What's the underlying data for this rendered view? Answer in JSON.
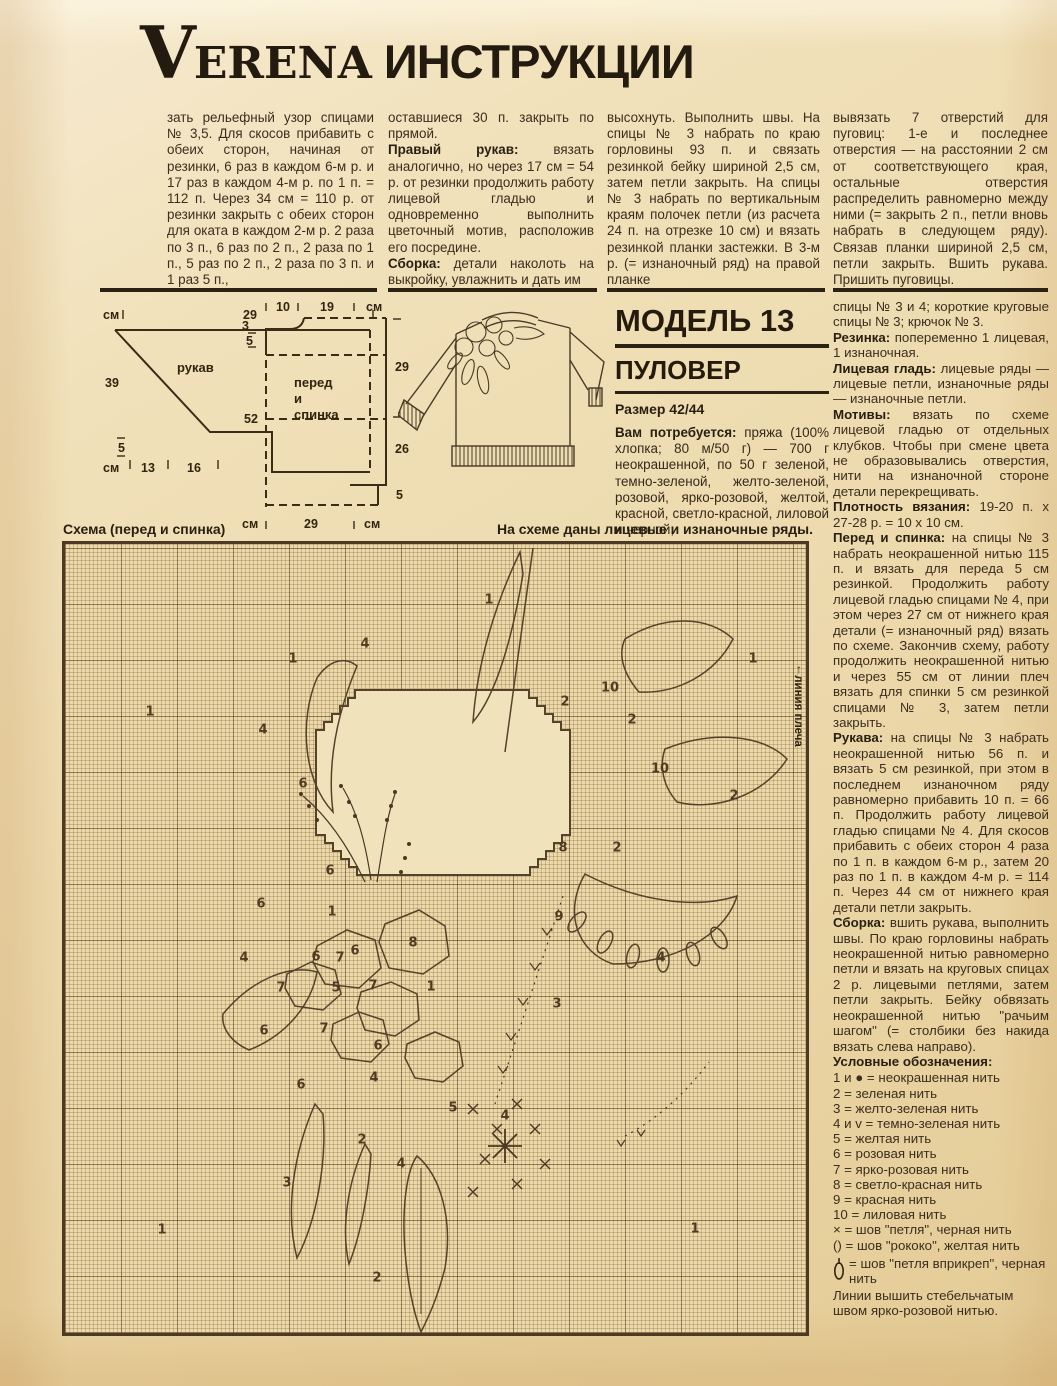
{
  "masthead": {
    "v": "V",
    "erena": "ERENA",
    "cyrillic": " ИНСТРУКЦИИ"
  },
  "colors": {
    "paper": "#f0e0b6",
    "ink": "#36291a",
    "grid": "#7a5c3a",
    "rule": "#2c2214"
  },
  "top_columns": [
    [
      [
        {
          "t": "зать рельефный узор спицами № 3,5. Для скосов прибавить с обеих сторон, начиная от резинки, 6 раз в каждом 6-м р. и 17 раз в каждом 4-м р. по 1 п. = 112 п. Через 34 см = 110 р. от резинки закрыть с обеих сторон для оката в каждом 2-м р. 2 раза по 3 п., 6 раз по 2 п., 2 раза по 1 п., 5 раз по 2 п., 2 раза по 3 п. и 1 раз 5 п.,"
        }
      ]
    ],
    [
      [
        {
          "t": "оставшиеся 30 п. закрыть по прямой."
        }
      ],
      [
        {
          "b": "Правый рукав:"
        },
        {
          "t": " вязать аналогично, но через 17 см = 54 р. от резинки продолжить работу лицевой гладью и одновременно выполнить цветочный мотив, расположив его посредине."
        }
      ],
      [
        {
          "b": "Сборка:"
        },
        {
          "t": " детали наколоть на выкройку, увлажнить и дать им"
        }
      ]
    ],
    [
      [
        {
          "t": "высохнуть. Выполнить швы. На спицы № 3 набрать по краю горловины 93 п. и связать резинкой бейку шириной 2,5 см, затем петли закрыть. На спицы № 3 набрать по вертикальным краям полочек петли (из расчета 24 п. на отрезке 10 см) и вязать резинкой планки застежки. В 3-м р. (= изнаночный ряд) на правой планке"
        }
      ]
    ],
    [
      [
        {
          "t": "вывязать 7 отверстий для пуговиц: 1-е и последнее отверстия — на расстоянии 2 см от соответствующего края, остальные отверстия распределить равномерно между ними (= закрыть 2 п., петли вновь набрать в следующем ряду). Связав планки шириной 2,5 см, петли закрыть. Вшить рукава. Пришить пуговицы."
        }
      ]
    ]
  ],
  "model": {
    "title": "МОДЕЛЬ 13",
    "subtitle": "ПУЛОВЕР",
    "size": "Размер 42/44",
    "paras": [
      [
        {
          "b": "Вам потребуется:"
        },
        {
          "t": " пряжа (100% хлопка; 80 м/50 г) — 700 г неокрашенной, по 50 г зеленой, темно-зеленой, желто-зеленой, розовой, ярко-розовой, желтой, красной, светло-красной, лиловой и черной;"
        }
      ]
    ]
  },
  "right_column": [
    [
      {
        "t": "спицы № 3 и 4; короткие круговые спицы № 3; крючок № 3."
      }
    ],
    [
      {
        "b": "Резинка:"
      },
      {
        "t": " попеременно 1 лицевая, 1 изнаночная."
      }
    ],
    [
      {
        "b": "Лицевая гладь:"
      },
      {
        "t": " лицевые ряды — лицевые петли, изнаночные ряды — изнаночные петли."
      }
    ],
    [
      {
        "b": "Мотивы:"
      },
      {
        "t": " вязать по схеме лицевой гладью от отдельных клубков. Чтобы при смене цвета не образовывались отверстия, нити на изнаночной стороне детали перекрещивать."
      }
    ],
    [
      {
        "b": "Плотность вязания:"
      },
      {
        "t": " 19-20 п. x 27-28 р. = 10 x 10 см."
      }
    ],
    [
      {
        "b": "Перед и спинка:"
      },
      {
        "t": " на спицы № 3 набрать неокрашенной нитью 115 п. и вязать для переда 5 см резинкой. Продолжить работу лицевой гладью спицами № 4, при этом через 27 см от нижнего края детали (= изнаночный ряд) вязать по схеме. Закончив схему, работу продолжить неокрашенной нитью и через 55 см от линии плеч вязать для спинки 5 см резинкой спицами № 3, затем петли закрыть."
      }
    ],
    [
      {
        "b": "Рукава:"
      },
      {
        "t": " на спицы № 3 набрать неокрашенной нитью 56 п. и вязать 5 см резинкой, при этом в последнем изнаночном ряду равномерно прибавить 10 п. = 66 п. Продолжить работу лицевой гладью спицами № 4. Для скосов прибавить с обеих сторон 4 раза по 1 п. в каждом 6-м р., затем 20 раз по 1 п. в каждом 4-м р. = 114 п. Через 44 см от нижнего края детали петли закрыть."
      }
    ],
    [
      {
        "b": "Сборка:"
      },
      {
        "t": " вшить рукава, выполнить швы. По краю горловины набрать неокрашенной нитью равномерно петли и вязать на круговых спицах 2 р. лицевыми петлями, затем петли закрыть. Бейку обвязать неокрашенной нитью \"рачьим шагом\" (= столбики без накида вязать слева направо)."
      }
    ],
    [
      {
        "b": "Условные обозначения:"
      }
    ]
  ],
  "legend": [
    "1 и ● = неокрашенная нить",
    "2 = зеленая нить",
    "3 = желто-зеленая нить",
    "4 и v = темно-зеленая нить",
    "5 = желтая нить",
    "6 = розовая нить",
    "7 = ярко-розовая нить",
    "8 = светло-красная нить",
    "9 = красная нить",
    "10 = лиловая нить",
    "× = шов \"петля\", черная нить",
    "() = шов \"рококо\", желтая нить"
  ],
  "legend_loop": {
    "rest": "= шов \"петля вприкреп\", черная нить"
  },
  "legend_note": "Линии вышить стебельчатым швом ярко-розовой нитью.",
  "schema": {
    "left_header": "Схема (перед и спинка)",
    "right_header": "На схеме даны лицевые и изнаночные ряды.",
    "shoulder_label": "линия плеча",
    "shoulder_arrow": "↑"
  },
  "diagrams": {
    "sleeve": {
      "label": "рукав",
      "unit_tl": "см",
      "unit_bl": "см",
      "w_top": "29",
      "h_left": "39",
      "h_rib": "5",
      "w_b1": "13",
      "w_b2": "16"
    },
    "front": {
      "label1": "перед",
      "label2": "и",
      "label3": "спинка",
      "unit_t": "см",
      "unit_bl": "см",
      "unit_br": "см",
      "t1": "10",
      "t2": "19",
      "l1": "3",
      "l2": "5",
      "l3": "52",
      "r1": "29",
      "r2": "26",
      "r3": "5",
      "b1": "29"
    }
  },
  "chart": {
    "labels": [
      {
        "t": "1",
        "x": 424,
        "y": 56
      },
      {
        "t": "4",
        "x": 300,
        "y": 100
      },
      {
        "t": "1",
        "x": 228,
        "y": 115
      },
      {
        "t": "1",
        "x": 688,
        "y": 115
      },
      {
        "t": "1",
        "x": 85,
        "y": 168
      },
      {
        "t": "4",
        "x": 198,
        "y": 186
      },
      {
        "t": "10",
        "x": 545,
        "y": 144
      },
      {
        "t": "2",
        "x": 500,
        "y": 158
      },
      {
        "t": "2",
        "x": 567,
        "y": 176
      },
      {
        "t": "10",
        "x": 595,
        "y": 225
      },
      {
        "t": "2",
        "x": 669,
        "y": 252
      },
      {
        "t": "6",
        "x": 238,
        "y": 240
      },
      {
        "t": "8",
        "x": 498,
        "y": 304
      },
      {
        "t": "2",
        "x": 552,
        "y": 304
      },
      {
        "t": "6",
        "x": 265,
        "y": 327
      },
      {
        "t": "6",
        "x": 196,
        "y": 360
      },
      {
        "t": "1",
        "x": 267,
        "y": 368
      },
      {
        "t": "9",
        "x": 494,
        "y": 373
      },
      {
        "t": "8",
        "x": 348,
        "y": 399
      },
      {
        "t": "4",
        "x": 179,
        "y": 414
      },
      {
        "t": "6",
        "x": 251,
        "y": 413
      },
      {
        "t": "7",
        "x": 275,
        "y": 414
      },
      {
        "t": "6",
        "x": 290,
        "y": 407
      },
      {
        "t": "7",
        "x": 216,
        "y": 444
      },
      {
        "t": "5",
        "x": 271,
        "y": 444
      },
      {
        "t": "7",
        "x": 308,
        "y": 442
      },
      {
        "t": "1",
        "x": 366,
        "y": 443
      },
      {
        "t": "3",
        "x": 492,
        "y": 460
      },
      {
        "t": "4",
        "x": 596,
        "y": 414
      },
      {
        "t": "6",
        "x": 199,
        "y": 487
      },
      {
        "t": "7",
        "x": 259,
        "y": 485
      },
      {
        "t": "6",
        "x": 313,
        "y": 502
      },
      {
        "t": "4",
        "x": 309,
        "y": 534
      },
      {
        "t": "6",
        "x": 236,
        "y": 541
      },
      {
        "t": "5",
        "x": 388,
        "y": 564
      },
      {
        "t": "4",
        "x": 440,
        "y": 572
      },
      {
        "t": "2",
        "x": 297,
        "y": 596
      },
      {
        "t": "4",
        "x": 336,
        "y": 620
      },
      {
        "t": "3",
        "x": 222,
        "y": 639
      },
      {
        "t": "1",
        "x": 97,
        "y": 686
      },
      {
        "t": "1",
        "x": 630,
        "y": 685
      },
      {
        "t": "2",
        "x": 312,
        "y": 734
      }
    ]
  }
}
